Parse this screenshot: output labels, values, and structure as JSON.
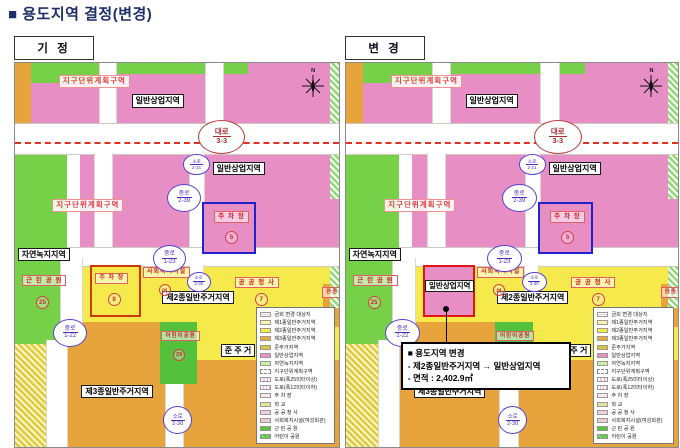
{
  "title": "■ 용도지역 결정(변경)",
  "panels": {
    "left": {
      "tag": "기 정",
      "variant": "base"
    },
    "right": {
      "tag": "변 경",
      "variant": "changed"
    }
  },
  "map": {
    "labels": {
      "district_plan": "지구단위계획구역",
      "commercial": "일반상업지역",
      "green_zone": "자연녹지지역",
      "residential2": "제2종일반주거지역",
      "residential3": "제3종일반주거지역",
      "semi_residential": "준 주 거",
      "parking": "주 차 장",
      "welfare": "사회복지시설",
      "public_office": "공 공 청 사",
      "neighborhood_park": "근 린 공 원",
      "children_park": "어린이공원",
      "buffer_green": "완충녹지",
      "north": "N"
    },
    "roads": {
      "daero": [
        "대로",
        "3-3"
      ],
      "jungro_2_39": [
        "중로",
        "2-39"
      ],
      "soro_2_21": [
        "소로",
        "2-21"
      ],
      "jungro_1_23": [
        "중로",
        "1-23"
      ],
      "jungro_1_22": [
        "중로",
        "1-22"
      ],
      "soro_3_30": [
        "소로",
        "3-30"
      ],
      "soro_2_30": [
        "소로",
        "2-30"
      ]
    },
    "numbers": {
      "parking_top": "5",
      "parking_left": "8",
      "public_office": "7",
      "neighborhood_park": "25",
      "children_park": "29",
      "welfare_circle": "여"
    }
  },
  "change_note": {
    "line1": "■ 용도지역 변경",
    "line2": "- 제2종일반주거지역 → 일반상업지역",
    "line3": "- 면적 : 2,402.9㎡"
  },
  "legend": {
    "items": [
      {
        "label": "금회 변경 대상지",
        "swatch": "target"
      },
      {
        "label": "제1종일반주거지역",
        "swatch": "r1"
      },
      {
        "label": "제2종일반주거지역",
        "swatch": "r2"
      },
      {
        "label": "제3종일반주거지역",
        "swatch": "r3"
      },
      {
        "label": "준주거지역",
        "swatch": "semi"
      },
      {
        "label": "일반상업지역",
        "swatch": "com"
      },
      {
        "label": "자연녹지지역",
        "swatch": "nat"
      },
      {
        "label": "지구단위계획구역",
        "swatch": "district"
      },
      {
        "label": "도로(폭25미터이상)",
        "swatch": "road1"
      },
      {
        "label": "도로(폭12미터이하)",
        "swatch": "road2"
      },
      {
        "label": "주 차 장",
        "swatch": "parking"
      },
      {
        "label": "학 교",
        "swatch": "school"
      },
      {
        "label": "공 공 청 사",
        "swatch": "office"
      },
      {
        "label": "사회복지시설(여성회관)",
        "swatch": "welfare"
      },
      {
        "label": "근 린 공 원",
        "swatch": "park"
      },
      {
        "label": "어린이 공원",
        "swatch": "cpark"
      }
    ]
  },
  "colors": {
    "commercial_pink": "#e78fc4",
    "residential2_yellow": "#f6e94b",
    "residential3_orange": "#e7a33c",
    "nature_green": "#77d148",
    "park_green": "#53c13c",
    "change_outline_red": "#e01515",
    "parcel_blue": "#2222cc",
    "road_dash_red": "#e03020",
    "title_navy": "#1d2f69"
  }
}
